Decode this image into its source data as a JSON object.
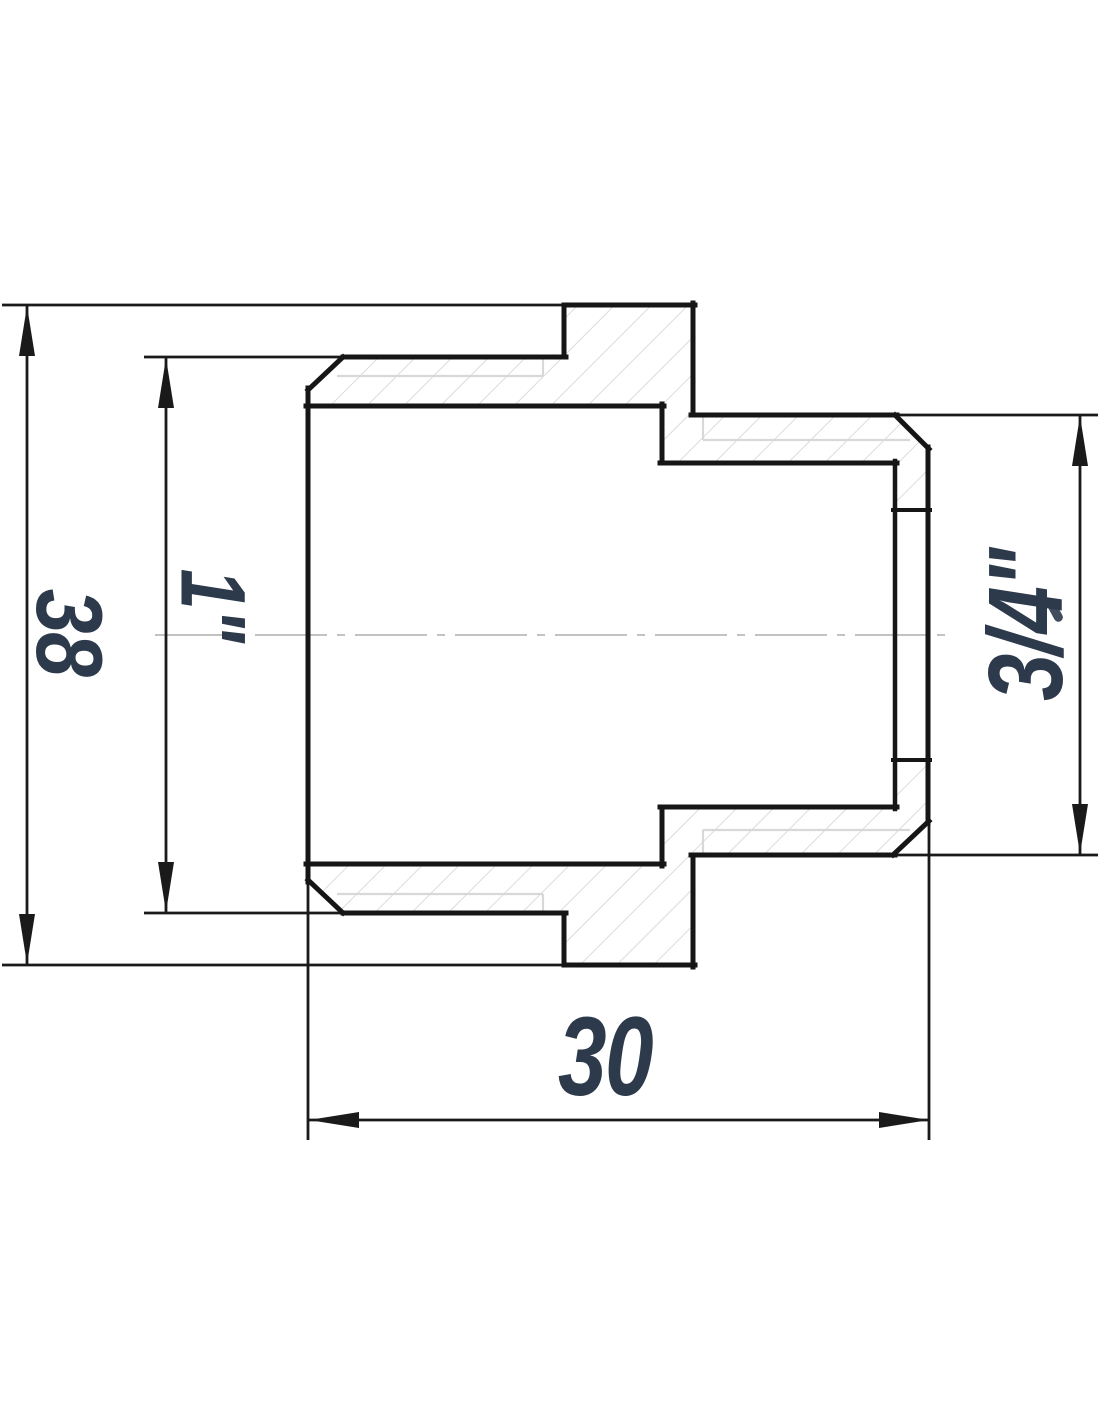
{
  "drawing": {
    "type": "technical-drawing-cross-section",
    "subject": "threaded reducing adapter fitting, sectioned side view",
    "dimensions": {
      "overall_diameter": {
        "value": "38",
        "orientation": "vertical",
        "side": "left-outer"
      },
      "female_thread": {
        "value": "1\"",
        "orientation": "vertical",
        "side": "left-inner"
      },
      "male_thread": {
        "value": "3/4\"",
        "orientation": "vertical",
        "side": "right"
      },
      "body_length": {
        "value": "30",
        "orientation": "horizontal",
        "side": "bottom"
      }
    },
    "colors": {
      "background": "#ffffff",
      "outline": "#161616",
      "dimension_lines": "#1a1a1a",
      "label_text": "#2d3a4b",
      "hatch": "#d3d3d3",
      "thread_thin_line": "#d8d8d8",
      "centerline": "#c2c2c2"
    }
  }
}
